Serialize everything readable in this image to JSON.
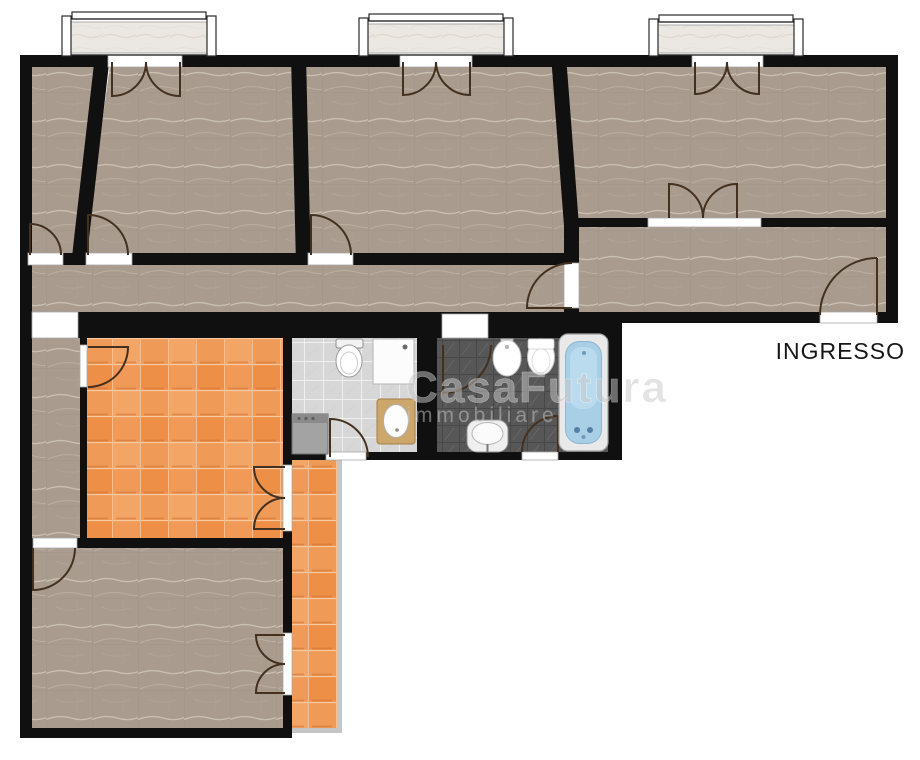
{
  "plan": {
    "labels": {
      "entrance": "INGRESSO"
    },
    "watermark": {
      "line1": "CasaFutura",
      "line2": "immobiliare"
    },
    "colors": {
      "wall": "#101010",
      "floor_tile": "#a99c8f",
      "kitchen_tile": "#f19a57",
      "bath_light_floor": "#d7d7d7",
      "bath_dark_floor": "#575757",
      "bathtub_water": "#a8cfe6",
      "window_sill": "#ebe8e3",
      "door_arc": "#43301f",
      "threshold": "#ffffff",
      "balcony_edge": "#c6c6c6",
      "fixture_white": "#ffffff",
      "cabinet_wood": "#cda66b",
      "washer_gray": "#a3a3a3",
      "label_text": "#161616",
      "watermark_text": "#c9c9c9"
    }
  }
}
